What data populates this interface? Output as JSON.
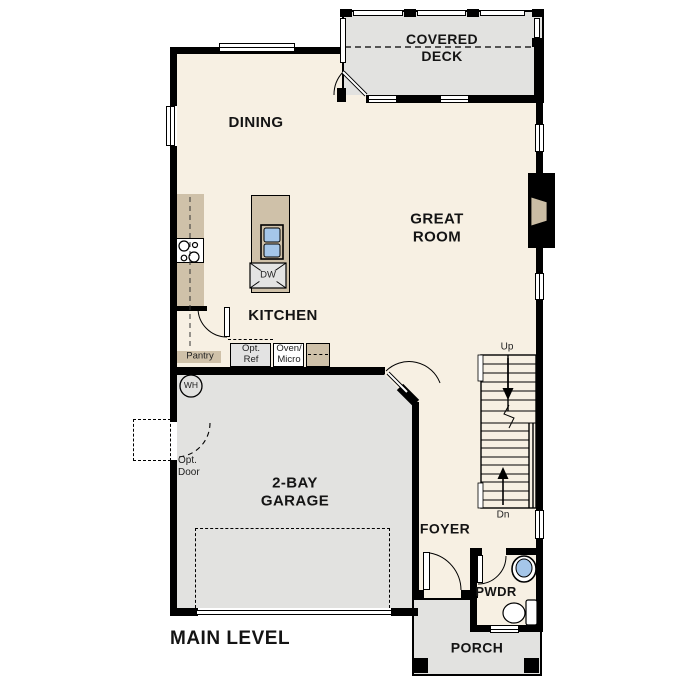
{
  "title": "MAIN LEVEL",
  "rooms": {
    "covered_deck": "COVERED DECK",
    "dining": "DINING",
    "great_room": "GREAT ROOM",
    "kitchen": "KITCHEN",
    "garage": "2-BAY GARAGE",
    "foyer": "FOYER",
    "pwdr": "PWDR",
    "porch": "PORCH"
  },
  "stairs": {
    "up": "Up",
    "dn": "Dn"
  },
  "labels": {
    "pantry": "Pantry",
    "opt_ref": "Opt. Ref",
    "oven_micro": "Oven/ Micro",
    "opt_door": "Opt. Door",
    "wh": "WH",
    "dw": "DW"
  },
  "colors": {
    "wall": "#000000",
    "interior": "#f7f0e3",
    "garage_gray": "#e2e2e0",
    "cabinet_tan": "#cfc1a9",
    "sink_blue": "#a5c6e9"
  }
}
